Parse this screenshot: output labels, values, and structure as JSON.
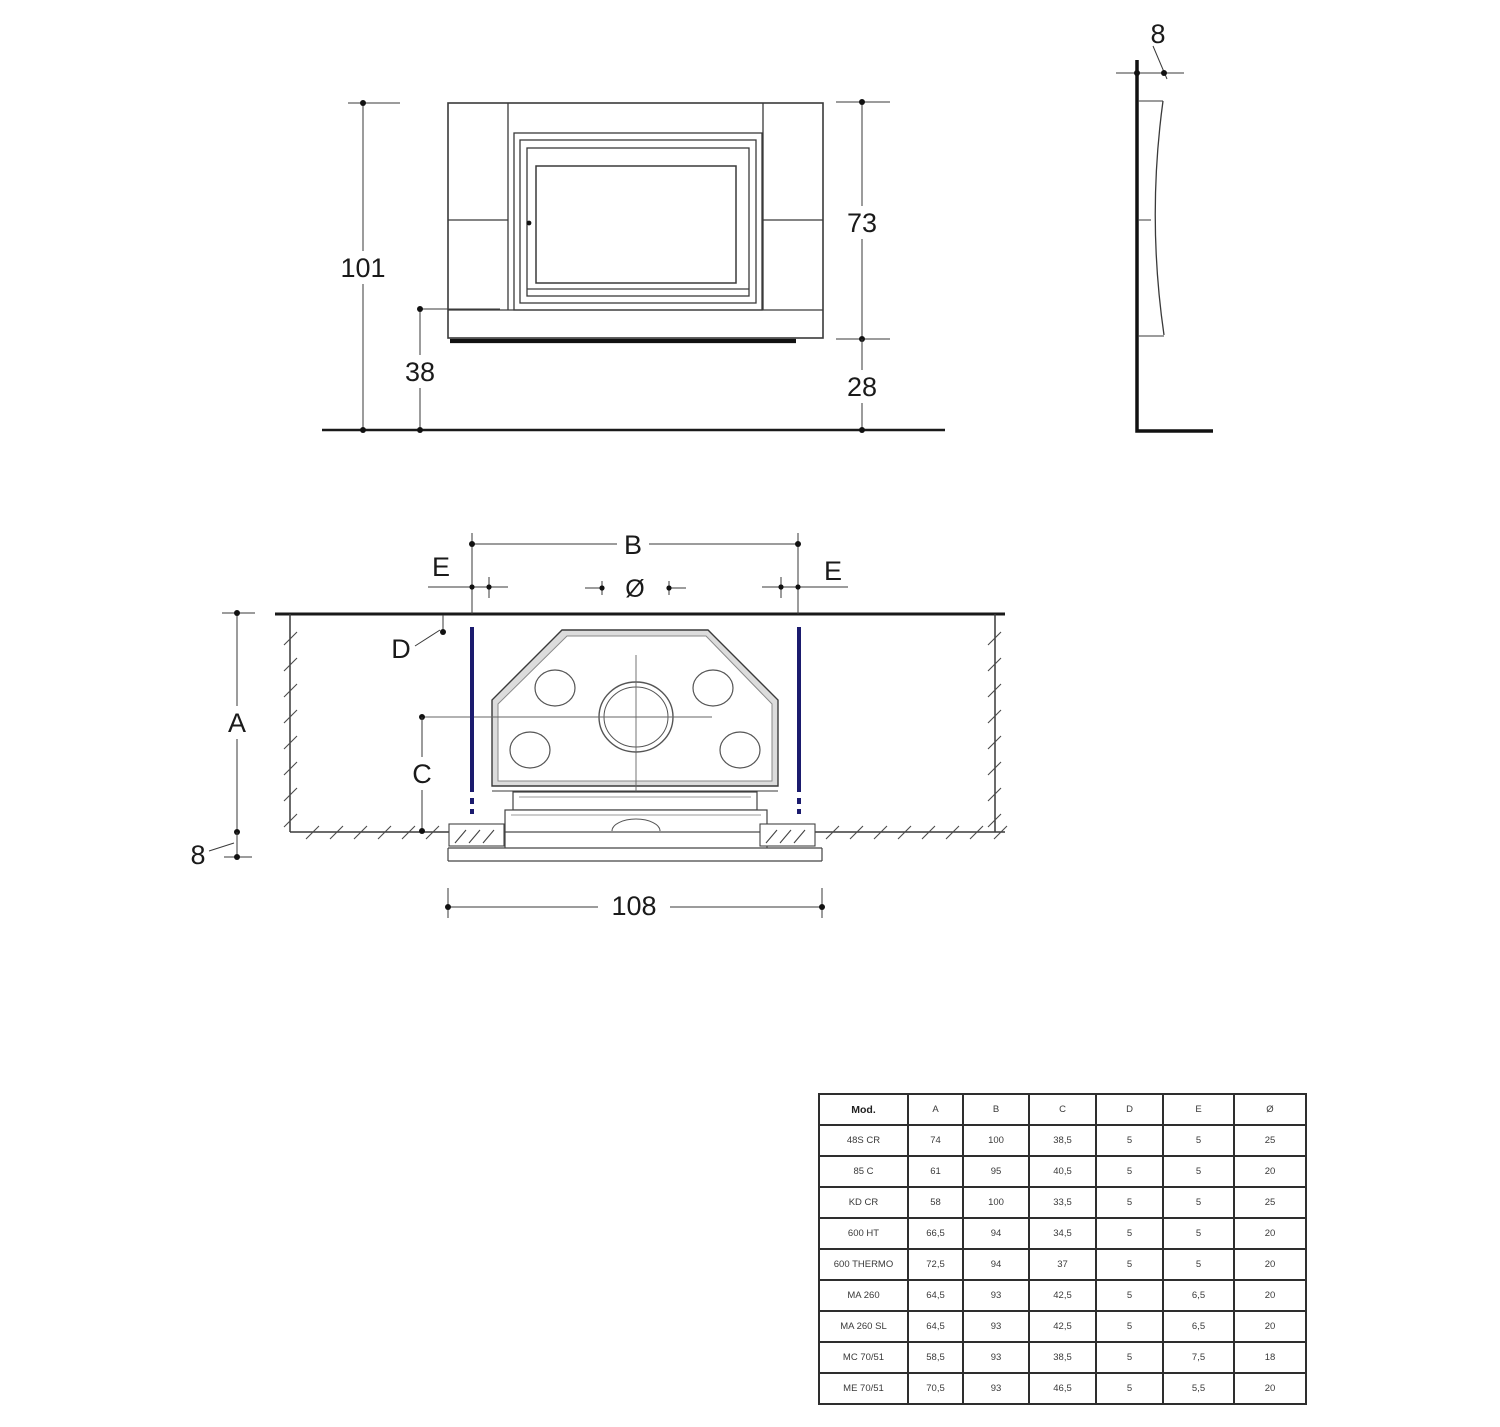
{
  "front_view": {
    "labels": {
      "total_height": "101",
      "insert_height": "73",
      "hearth_height": "38",
      "base_height": "28"
    }
  },
  "side_view": {
    "labels": {
      "wall_offset": "8"
    }
  },
  "plan_view": {
    "labels": {
      "b": "B",
      "e_left": "E",
      "e_right": "E",
      "diameter": "Ø",
      "d": "D",
      "a": "A",
      "c": "C",
      "wall_thickness": "8",
      "overall_width": "108"
    }
  },
  "colors": {
    "line": "#3a3a3a",
    "accent_blue": "#1b1b6e"
  },
  "table": {
    "headers": [
      "Mod.",
      "A",
      "B",
      "C",
      "D",
      "E",
      "Ø"
    ],
    "rows": [
      [
        "48S CR",
        "74",
        "100",
        "38,5",
        "5",
        "5",
        "25"
      ],
      [
        "85 C",
        "61",
        "95",
        "40,5",
        "5",
        "5",
        "20"
      ],
      [
        "KD CR",
        "58",
        "100",
        "33,5",
        "5",
        "5",
        "25"
      ],
      [
        "600 HT",
        "66,5",
        "94",
        "34,5",
        "5",
        "5",
        "20"
      ],
      [
        "600 THERMO",
        "72,5",
        "94",
        "37",
        "5",
        "5",
        "20"
      ],
      [
        "MA 260",
        "64,5",
        "93",
        "42,5",
        "5",
        "6,5",
        "20"
      ],
      [
        "MA 260 SL",
        "64,5",
        "93",
        "42,5",
        "5",
        "6,5",
        "20"
      ],
      [
        "MC 70/51",
        "58,5",
        "93",
        "38,5",
        "5",
        "7,5",
        "18"
      ],
      [
        "ME 70/51",
        "70,5",
        "93",
        "46,5",
        "5",
        "5,5",
        "20"
      ]
    ]
  }
}
